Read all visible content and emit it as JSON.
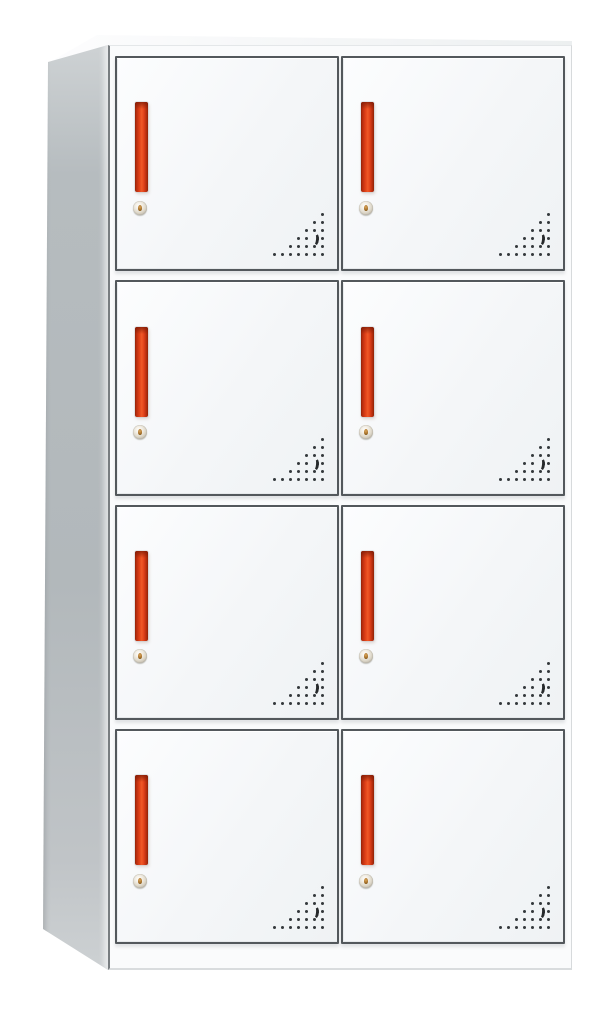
{
  "scene": {
    "description": "Product photo of a white steel 8-door locker storage cabinet shown in slight left perspective on a plain white background. Two columns by four rows of square doors; each door has a vertical red-orange recessed handle, a round silver cam lock with brass keyhole below it, and a triangular cluster of round ventilation perforations with a crescent-shaped cutout in the bottom-right corner.",
    "visible_text": []
  },
  "cabinet": {
    "type": "locker-cabinet",
    "rows": 4,
    "columns": 2,
    "door_count": 8,
    "colors": {
      "background": "#ffffff",
      "body_white": "#fafbfc",
      "door_face": "#f4f6f8",
      "door_border": "#53585c",
      "frame_edge_dark": "#787d80",
      "side_panel": "#b6bcbf",
      "handle_red": "#e2421a",
      "handle_red_bright": "#ef5827",
      "handle_red_dark": "#8f2306",
      "vent_dot": "#34393c",
      "lock_silver": "#ded8ca",
      "lock_brass": "#a9742c"
    },
    "doors": [
      {
        "id": "locker-door-r1-c1",
        "row": 1,
        "col": 1,
        "features": [
          "handle",
          "lock",
          "vents"
        ]
      },
      {
        "id": "locker-door-r1-c2",
        "row": 1,
        "col": 2,
        "features": [
          "handle",
          "lock",
          "vents"
        ]
      },
      {
        "id": "locker-door-r2-c1",
        "row": 2,
        "col": 1,
        "features": [
          "handle",
          "lock",
          "vents"
        ]
      },
      {
        "id": "locker-door-r2-c2",
        "row": 2,
        "col": 2,
        "features": [
          "handle",
          "lock",
          "vents"
        ]
      },
      {
        "id": "locker-door-r3-c1",
        "row": 3,
        "col": 1,
        "features": [
          "handle",
          "lock",
          "vents"
        ]
      },
      {
        "id": "locker-door-r3-c2",
        "row": 3,
        "col": 2,
        "features": [
          "handle",
          "lock",
          "vents"
        ]
      },
      {
        "id": "locker-door-r4-c1",
        "row": 4,
        "col": 1,
        "features": [
          "handle",
          "lock",
          "vents"
        ]
      },
      {
        "id": "locker-door-r4-c2",
        "row": 4,
        "col": 2,
        "features": [
          "handle",
          "lock",
          "vents"
        ]
      }
    ],
    "handle": {
      "width_px": 13,
      "height_px": 90,
      "orientation": "vertical"
    },
    "lock": {
      "diameter_px": 14,
      "shape": "round-cam-lock"
    },
    "vent_pattern": {
      "anchor": "bottom-right",
      "spacing_px": 8,
      "dot_px": 3,
      "rows_cols_from_right": [
        [
          0
        ],
        [
          0,
          1
        ],
        [
          0,
          1,
          2
        ],
        [
          0,
          2,
          3
        ],
        [
          0,
          1,
          2,
          3,
          4
        ],
        [
          0,
          1,
          2,
          3,
          4,
          5,
          6
        ]
      ],
      "crescent": {
        "row": 3,
        "col": 1
      }
    }
  }
}
